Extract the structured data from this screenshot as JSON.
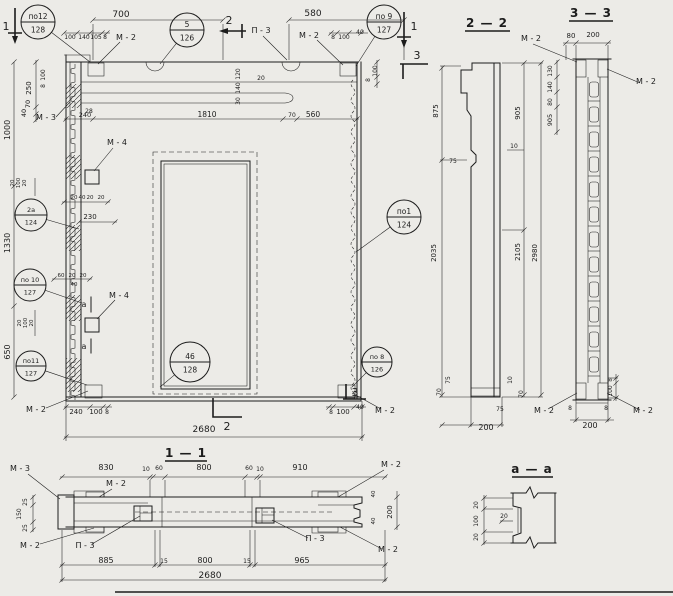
{
  "colors": {
    "paper": "#ecebe7",
    "ink": "#1c1c1c"
  },
  "sections": {
    "s11": "1 — 1",
    "s22": "2 — 2",
    "s33": "3 — 3",
    "saa": "a — a"
  },
  "callouts": [
    {
      "top": "по12",
      "bottom": "128",
      "cx": 38,
      "cy": 22,
      "r": 17,
      "lx": 90,
      "ly": 62
    },
    {
      "top": "5",
      "bottom": "126",
      "cx": 187,
      "cy": 30,
      "r": 17,
      "lx": 160,
      "ly": 64
    },
    {
      "top": "по 9",
      "bottom": "127",
      "cx": 384,
      "cy": 22,
      "r": 17,
      "lx": 356,
      "ly": 66
    },
    {
      "top": "2a",
      "bottom": "124",
      "cx": 31,
      "cy": 215,
      "r": 16,
      "lx": 79,
      "ly": 229
    },
    {
      "top": "по 10",
      "bottom": "127",
      "cx": 30,
      "cy": 285,
      "r": 16,
      "lx": 82,
      "ly": 303
    },
    {
      "top": "по11",
      "bottom": "127",
      "cx": 31,
      "cy": 366,
      "r": 15,
      "lx": 87,
      "ly": 385
    },
    {
      "top": "по1",
      "bottom": "124",
      "cx": 404,
      "cy": 217,
      "r": 17,
      "lx": 356,
      "ly": 252
    },
    {
      "top": "по 8",
      "bottom": "126",
      "cx": 377,
      "cy": 362,
      "r": 15,
      "lx": 352,
      "ly": 387
    },
    {
      "top": "46",
      "bottom": "128",
      "cx": 190,
      "cy": 362,
      "r": 20,
      "lx": 160,
      "ly": 387
    }
  ],
  "labels": [
    {
      "t": "700",
      "x": 121,
      "y": 17,
      "s": 9
    },
    {
      "t": "580",
      "x": 313,
      "y": 16,
      "s": 9
    },
    {
      "t": "100",
      "x": 70,
      "y": 39,
      "s": 6
    },
    {
      "t": "140",
      "x": 84,
      "y": 39,
      "s": 6
    },
    {
      "t": "105",
      "x": 96,
      "y": 39,
      "s": 6
    },
    {
      "t": "8",
      "x": 105,
      "y": 39,
      "s": 6
    },
    {
      "t": "M - 2",
      "x": 126,
      "y": 40,
      "s": 8
    },
    {
      "t": "П - 3",
      "x": 261,
      "y": 33,
      "s": 8
    },
    {
      "t": "M - 2",
      "x": 309,
      "y": 38,
      "s": 8
    },
    {
      "t": "8",
      "x": 333,
      "y": 39,
      "s": 6
    },
    {
      "t": "100",
      "x": 344,
      "y": 39,
      "s": 6
    },
    {
      "t": "40",
      "x": 360,
      "y": 34,
      "s": 6
    },
    {
      "t": "100",
      "x": 377,
      "y": 71,
      "r": -90,
      "s": 6
    },
    {
      "t": "8",
      "x": 370,
      "y": 80,
      "r": -90,
      "s": 6
    },
    {
      "t": "250",
      "x": 31,
      "y": 88,
      "r": -90,
      "s": 7
    },
    {
      "t": "100",
      "x": 45,
      "y": 75,
      "r": -90,
      "s": 6
    },
    {
      "t": "8",
      "x": 45,
      "y": 86,
      "r": -90,
      "s": 6
    },
    {
      "t": "70",
      "x": 30,
      "y": 104,
      "r": -90,
      "s": 6.5
    },
    {
      "t": "40",
      "x": 26,
      "y": 113,
      "r": -90,
      "s": 6.5
    },
    {
      "t": "1000",
      "x": 10,
      "y": 130,
      "r": -90,
      "s": 8
    },
    {
      "t": "1330",
      "x": 10,
      "y": 243,
      "r": -90,
      "s": 8
    },
    {
      "t": "650",
      "x": 10,
      "y": 352,
      "r": -90,
      "s": 8
    },
    {
      "t": "M - 3",
      "x": 46,
      "y": 120,
      "s": 8
    },
    {
      "t": "28",
      "x": 89,
      "y": 113,
      "s": 6
    },
    {
      "t": "240",
      "x": 85,
      "y": 117,
      "s": 6.5
    },
    {
      "t": "1810",
      "x": 207,
      "y": 117,
      "s": 7.5
    },
    {
      "t": "70",
      "x": 292,
      "y": 117,
      "s": 6
    },
    {
      "t": "560",
      "x": 313,
      "y": 117,
      "s": 7.5
    },
    {
      "t": "120",
      "x": 240,
      "y": 74,
      "r": -90,
      "s": 6
    },
    {
      "t": "140",
      "x": 240,
      "y": 88,
      "r": -90,
      "s": 6
    },
    {
      "t": "30",
      "x": 240,
      "y": 101,
      "r": -90,
      "s": 6
    },
    {
      "t": "20",
      "x": 261,
      "y": 80,
      "s": 6
    },
    {
      "t": "M - 4",
      "x": 117,
      "y": 145,
      "s": 8
    },
    {
      "t": "20",
      "x": 74,
      "y": 199,
      "s": 5.5
    },
    {
      "t": "40",
      "x": 82,
      "y": 199,
      "s": 5.5
    },
    {
      "t": "20",
      "x": 90,
      "y": 199,
      "s": 5.5
    },
    {
      "t": "20",
      "x": 101,
      "y": 199,
      "s": 5.5
    },
    {
      "t": "230",
      "x": 90,
      "y": 219,
      "s": 7
    },
    {
      "t": "20",
      "x": 14,
      "y": 183,
      "r": -90,
      "s": 5.5
    },
    {
      "t": "100",
      "x": 20,
      "y": 183,
      "r": -90,
      "s": 5.5
    },
    {
      "t": "20",
      "x": 26,
      "y": 183,
      "r": -90,
      "s": 5.5
    },
    {
      "t": "60",
      "x": 61,
      "y": 277,
      "s": 5.5
    },
    {
      "t": "20",
      "x": 72,
      "y": 277,
      "s": 5.5
    },
    {
      "t": "20",
      "x": 83,
      "y": 277,
      "s": 5.5
    },
    {
      "t": "40",
      "x": 74,
      "y": 286,
      "s": 5.5
    },
    {
      "t": "M - 4",
      "x": 119,
      "y": 298,
      "s": 8
    },
    {
      "t": "a",
      "x": 84,
      "y": 307,
      "s": 8
    },
    {
      "t": "a",
      "x": 84,
      "y": 349,
      "s": 8
    },
    {
      "t": "20",
      "x": 21,
      "y": 323,
      "r": -90,
      "s": 5.5
    },
    {
      "t": "100",
      "x": 27,
      "y": 323,
      "r": -90,
      "s": 5.5
    },
    {
      "t": "20",
      "x": 33,
      "y": 323,
      "r": -90,
      "s": 5.5
    },
    {
      "t": "M - 2",
      "x": 36,
      "y": 412,
      "s": 8
    },
    {
      "t": "240",
      "x": 76,
      "y": 414,
      "s": 7
    },
    {
      "t": "100",
      "x": 96,
      "y": 414,
      "s": 7
    },
    {
      "t": "8",
      "x": 107,
      "y": 414,
      "s": 6
    },
    {
      "t": "8",
      "x": 331,
      "y": 414,
      "s": 6
    },
    {
      "t": "100",
      "x": 343,
      "y": 414,
      "s": 7
    },
    {
      "t": "40",
      "x": 360,
      "y": 409,
      "s": 6
    },
    {
      "t": "M - 2",
      "x": 385,
      "y": 413,
      "s": 8
    },
    {
      "t": "2680",
      "x": 204,
      "y": 432,
      "s": 9
    },
    {
      "t": "1",
      "x": 6,
      "y": 30,
      "s": 11
    },
    {
      "t": "1",
      "x": 414,
      "y": 30,
      "s": 11
    },
    {
      "t": "2",
      "x": 229,
      "y": 24,
      "s": 11
    },
    {
      "t": "2",
      "x": 227,
      "y": 430,
      "s": 11
    },
    {
      "t": "3",
      "x": 417,
      "y": 59,
      "s": 11
    },
    {
      "t": "3",
      "x": 355,
      "y": 396,
      "s": 11
    },
    {
      "t": "M - 2",
      "x": 531,
      "y": 41,
      "s": 8
    },
    {
      "t": "875",
      "x": 438,
      "y": 111,
      "r": -90,
      "s": 7
    },
    {
      "t": "905",
      "x": 520,
      "y": 113,
      "r": -90,
      "s": 7
    },
    {
      "t": "2035",
      "x": 436,
      "y": 253,
      "r": -90,
      "s": 7
    },
    {
      "t": "2105",
      "x": 520,
      "y": 252,
      "r": -90,
      "s": 7
    },
    {
      "t": "2980",
      "x": 537,
      "y": 253,
      "r": -90,
      "s": 7
    },
    {
      "t": "10",
      "x": 514,
      "y": 148,
      "s": 6
    },
    {
      "t": "75",
      "x": 453,
      "y": 163,
      "s": 6
    },
    {
      "t": "75",
      "x": 450,
      "y": 380,
      "r": -90,
      "s": 6
    },
    {
      "t": "70",
      "x": 441,
      "y": 392,
      "r": -90,
      "s": 6
    },
    {
      "t": "10",
      "x": 512,
      "y": 380,
      "r": -90,
      "s": 6
    },
    {
      "t": "70",
      "x": 523,
      "y": 394,
      "r": -90,
      "s": 6
    },
    {
      "t": "75",
      "x": 500,
      "y": 411,
      "s": 6
    },
    {
      "t": "200",
      "x": 486,
      "y": 430,
      "s": 8
    },
    {
      "t": "80",
      "x": 571,
      "y": 38,
      "s": 7
    },
    {
      "t": "200",
      "x": 593,
      "y": 37,
      "s": 7
    },
    {
      "t": "M - 2",
      "x": 646,
      "y": 84,
      "s": 8
    },
    {
      "t": "130",
      "x": 552,
      "y": 71,
      "r": -90,
      "s": 6
    },
    {
      "t": "140",
      "x": 552,
      "y": 87,
      "r": -90,
      "s": 6
    },
    {
      "t": "80",
      "x": 552,
      "y": 102,
      "r": -90,
      "s": 6
    },
    {
      "t": "905",
      "x": 552,
      "y": 120,
      "r": -90,
      "s": 6.5
    },
    {
      "t": "8",
      "x": 612,
      "y": 380,
      "r": -90,
      "s": 5.5
    },
    {
      "t": "100",
      "x": 612,
      "y": 391,
      "r": -90,
      "s": 6
    },
    {
      "t": "M - 2",
      "x": 544,
      "y": 413,
      "s": 8
    },
    {
      "t": "8",
      "x": 570,
      "y": 410,
      "s": 6
    },
    {
      "t": "8",
      "x": 606,
      "y": 410,
      "s": 6
    },
    {
      "t": "M - 2",
      "x": 643,
      "y": 413,
      "s": 8
    },
    {
      "t": "200",
      "x": 590,
      "y": 428,
      "s": 8
    },
    {
      "t": "M - 3",
      "x": 20,
      "y": 471,
      "s": 8
    },
    {
      "t": "830",
      "x": 106,
      "y": 470,
      "s": 8
    },
    {
      "t": "10",
      "x": 146,
      "y": 471,
      "s": 6
    },
    {
      "t": "60",
      "x": 159,
      "y": 470,
      "s": 6
    },
    {
      "t": "800",
      "x": 204,
      "y": 470,
      "s": 8
    },
    {
      "t": "60",
      "x": 249,
      "y": 470,
      "s": 6
    },
    {
      "t": "10",
      "x": 260,
      "y": 471,
      "s": 6
    },
    {
      "t": "910",
      "x": 300,
      "y": 470,
      "s": 8
    },
    {
      "t": "M - 2",
      "x": 116,
      "y": 486,
      "s": 8
    },
    {
      "t": "M - 2",
      "x": 391,
      "y": 467,
      "s": 8
    },
    {
      "t": "25",
      "x": 27,
      "y": 502,
      "r": -90,
      "s": 6
    },
    {
      "t": "150",
      "x": 21,
      "y": 514,
      "r": -90,
      "s": 6
    },
    {
      "t": "25",
      "x": 27,
      "y": 528,
      "r": -90,
      "s": 6
    },
    {
      "t": "M - 2",
      "x": 30,
      "y": 548,
      "s": 8
    },
    {
      "t": "П - 3",
      "x": 85,
      "y": 548,
      "s": 8
    },
    {
      "t": "П - 3",
      "x": 315,
      "y": 541,
      "s": 8
    },
    {
      "t": "M - 2",
      "x": 388,
      "y": 552,
      "s": 8
    },
    {
      "t": "40",
      "x": 375,
      "y": 494,
      "r": -90,
      "s": 5.5
    },
    {
      "t": "200",
      "x": 392,
      "y": 512,
      "r": -90,
      "s": 7
    },
    {
      "t": "40",
      "x": 375,
      "y": 521,
      "r": -90,
      "s": 5.5
    },
    {
      "t": "885",
      "x": 106,
      "y": 563,
      "s": 8
    },
    {
      "t": "15",
      "x": 164,
      "y": 563,
      "s": 6
    },
    {
      "t": "800",
      "x": 205,
      "y": 563,
      "s": 8
    },
    {
      "t": "15",
      "x": 247,
      "y": 563,
      "s": 6
    },
    {
      "t": "965",
      "x": 302,
      "y": 563,
      "s": 8
    },
    {
      "t": "2680",
      "x": 210,
      "y": 578,
      "s": 9
    },
    {
      "t": "20",
      "x": 478,
      "y": 505,
      "r": -90,
      "s": 6
    },
    {
      "t": "100",
      "x": 478,
      "y": 521,
      "r": -90,
      "s": 6
    },
    {
      "t": "20",
      "x": 478,
      "y": 537,
      "r": -90,
      "s": 6
    },
    {
      "t": "20",
      "x": 504,
      "y": 518,
      "s": 6
    }
  ]
}
